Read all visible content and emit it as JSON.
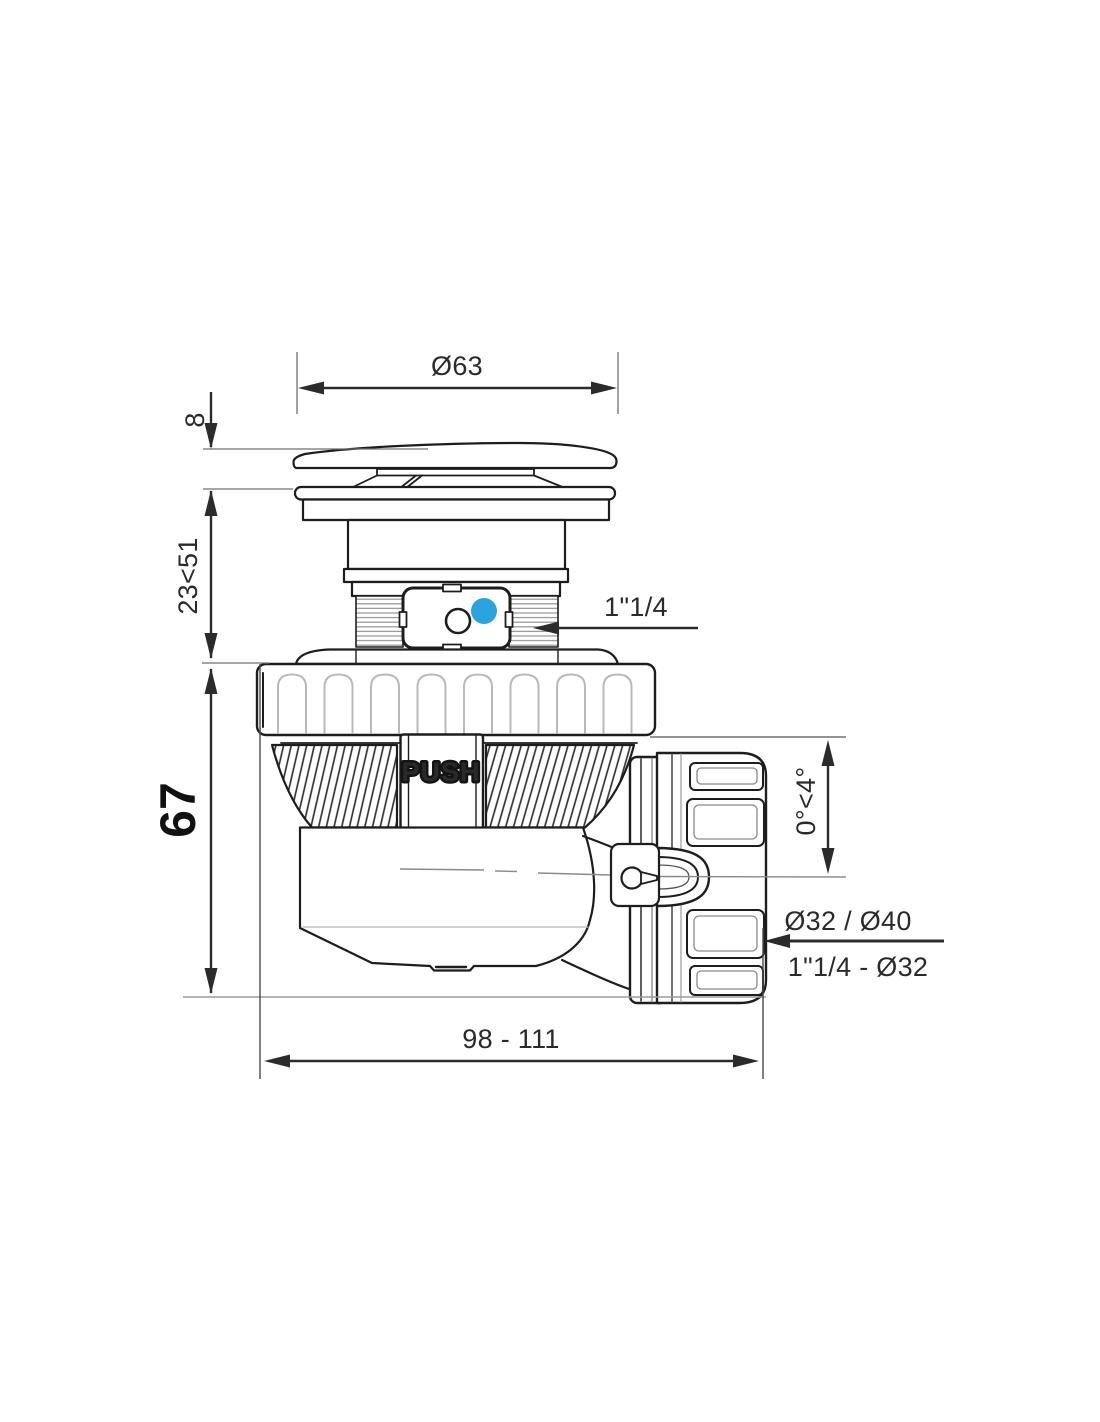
{
  "diagram": {
    "title": "Pop-up waste drain trap - dimensional side view",
    "colors": {
      "line": "#1d1d1d",
      "dimension": "#2b2b2b",
      "light_detail": "#b9b9b9",
      "indicator_blue": "#2BA3DC"
    },
    "indicator": {
      "shape": "dot",
      "color": "#2BA3DC"
    }
  },
  "labels": {
    "push": "PUSH"
  },
  "dims": {
    "cap_diameter": "Ø63",
    "cap_height": "8",
    "adjustable_height": "23<51",
    "body_height": "67",
    "inlet_thread": "1\"1/4",
    "outlet_angle": "0°<4°",
    "outlet_diameters": "Ø32 / Ø40",
    "outlet_thread": "1\"1/4 - Ø32",
    "overall_length": "98 - 111"
  }
}
